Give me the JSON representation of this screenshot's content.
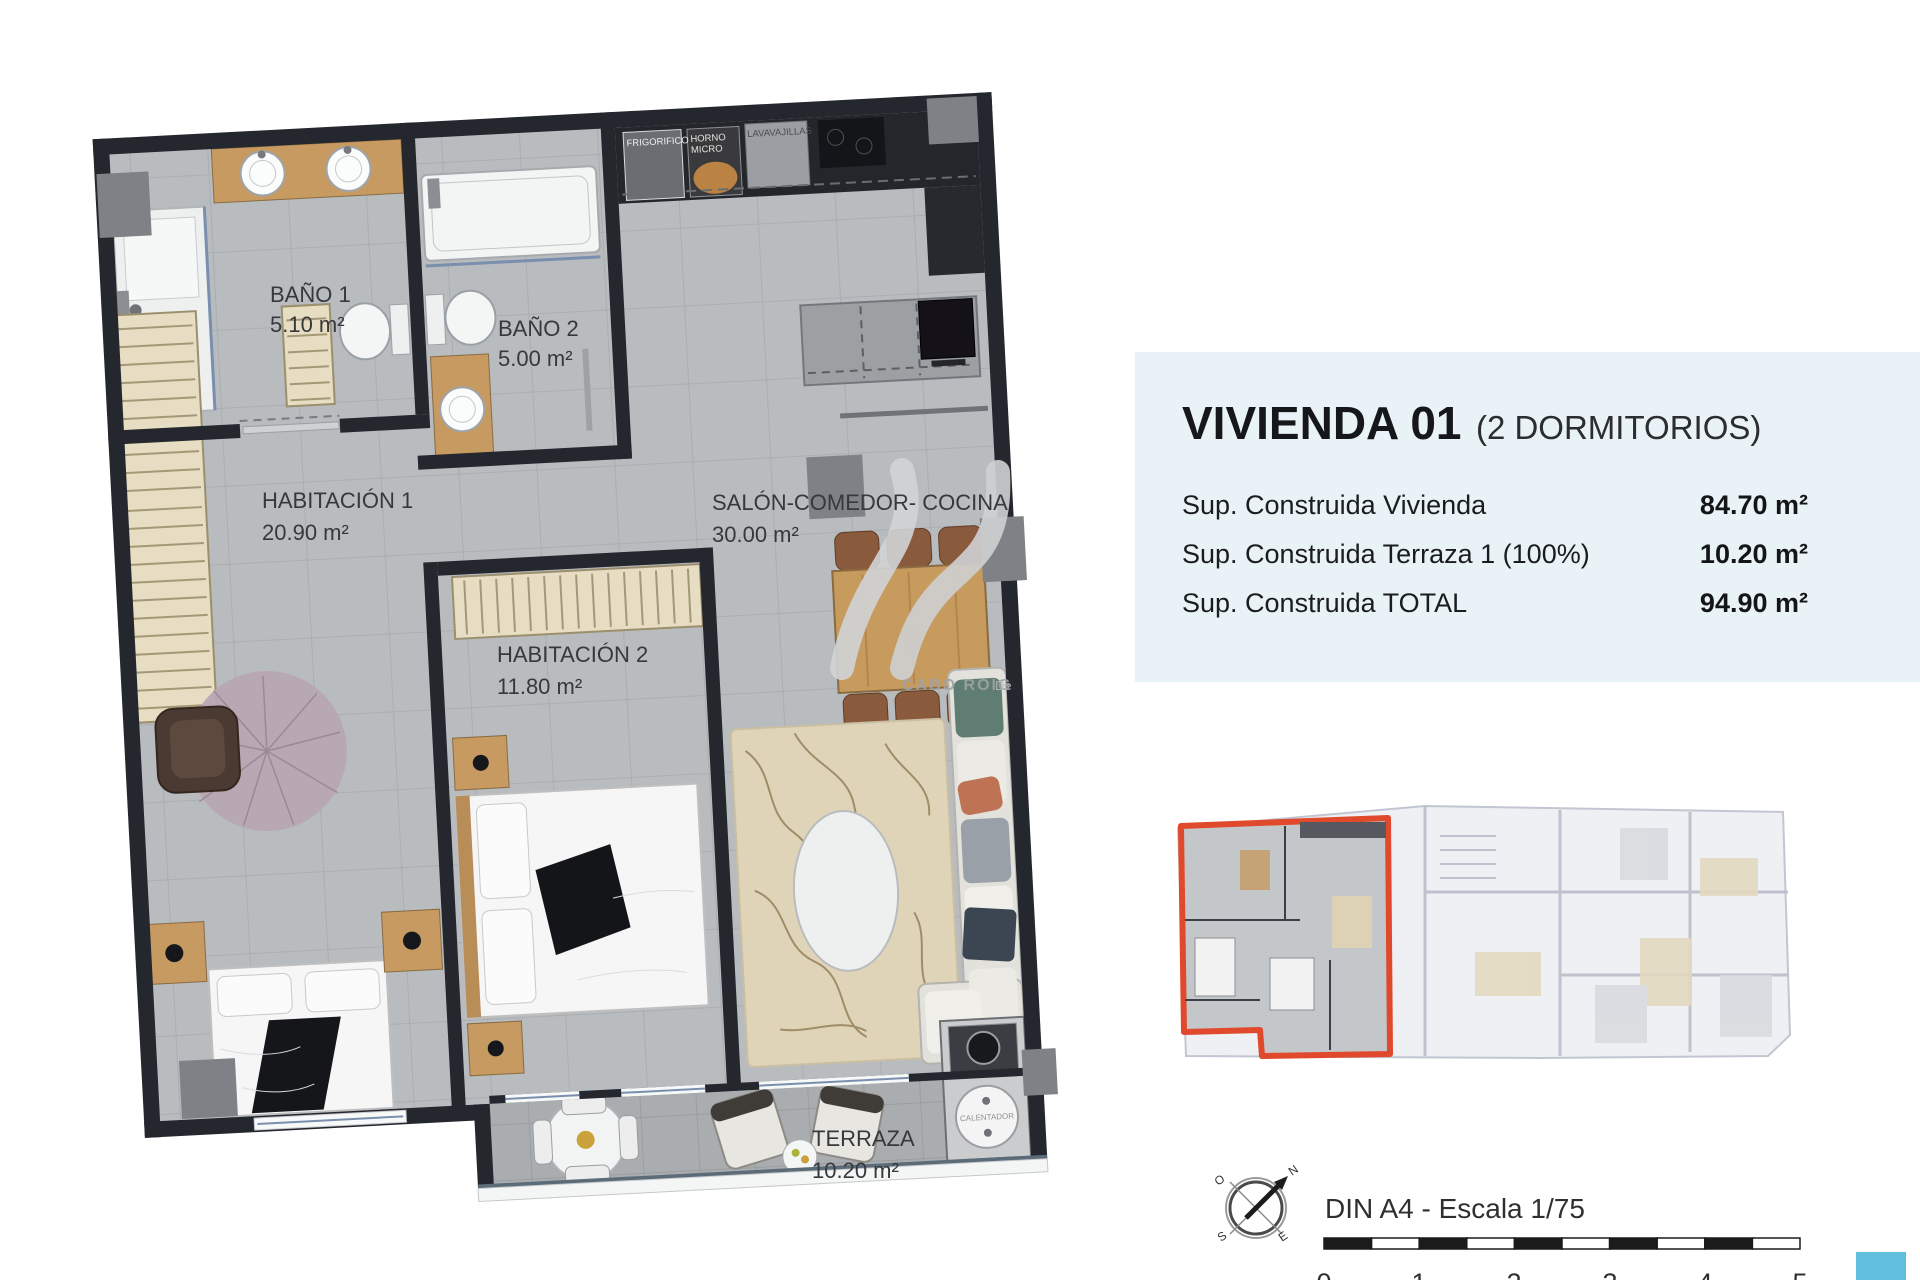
{
  "panel": {
    "title": "VIVIENDA 01",
    "subtitle": "(2 DORMITORIOS)",
    "rows": [
      {
        "label": "Sup. Construida Vivienda",
        "value": "84.70 m²"
      },
      {
        "label": "Sup. Construida Terraza 1 (100%)",
        "value": "10.20 m²"
      },
      {
        "label": "Sup. Construida TOTAL",
        "value": "94.90 m²"
      }
    ]
  },
  "plan": {
    "rooms": [
      {
        "name": "BAÑO 1",
        "area": "5.10 m²"
      },
      {
        "name": "BAÑO 2",
        "area": "5.00 m²"
      },
      {
        "name": "HABITACIÓN 1",
        "area": "20.90 m²"
      },
      {
        "name": "HABITACIÓN 2",
        "area": "11.80 m²"
      },
      {
        "name": "SALÓN-COMEDOR- COCINA",
        "area": "30.00 m²"
      },
      {
        "name": "TERRAZA",
        "area": "10.20 m²"
      }
    ],
    "appliances": {
      "fridge": "FRIGORIFICO",
      "oven_line1": "HORNO",
      "oven_line2": "MICRO",
      "dishwasher": "LAVAVAJILLAS",
      "heater": "CALENTADOR"
    }
  },
  "watermark": {
    "brand": "CABO ROIG",
    "suffix": "De"
  },
  "footer": {
    "scale_title": "DIN A4 - Escala 1/75",
    "ticks": [
      "0",
      "1",
      "2",
      "3",
      "4",
      "5"
    ],
    "compass": {
      "n": "N",
      "o": "O",
      "s": "S",
      "e": "E"
    }
  },
  "colors": {
    "panel_bg": "#e9f2f7",
    "wall": "#24272d",
    "accent_red": "#e0492c",
    "cyan": "#62bedd",
    "floor": "#b8bcbf",
    "terrace_floor": "#a9adb0",
    "wood": "#c79a62"
  }
}
